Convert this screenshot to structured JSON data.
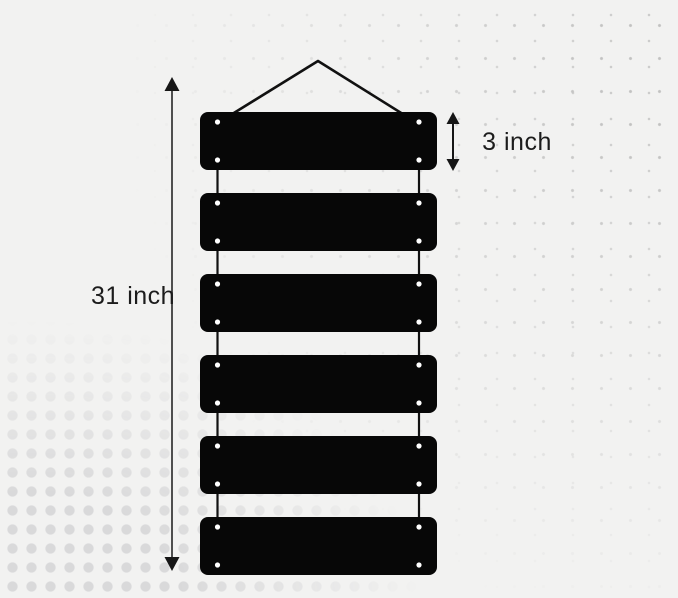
{
  "scene": {
    "description": "Dimension diagram of a hanging six-slat black sign board",
    "annotations": {
      "total_height_label": "31 inch",
      "slat_height_label": "3 inch"
    },
    "diagram": {
      "slat_count": 6,
      "holes_per_slat": 4
    },
    "colors": {
      "background": "#f2f2f1",
      "slat": "#070707",
      "string": "#111111",
      "hole": "#ffffff",
      "dimension_line": "#4f4f4f",
      "dimension_arrow": "#161616",
      "label_text": "#1c1c1c",
      "halftone_dot": "#d9d9da"
    }
  }
}
